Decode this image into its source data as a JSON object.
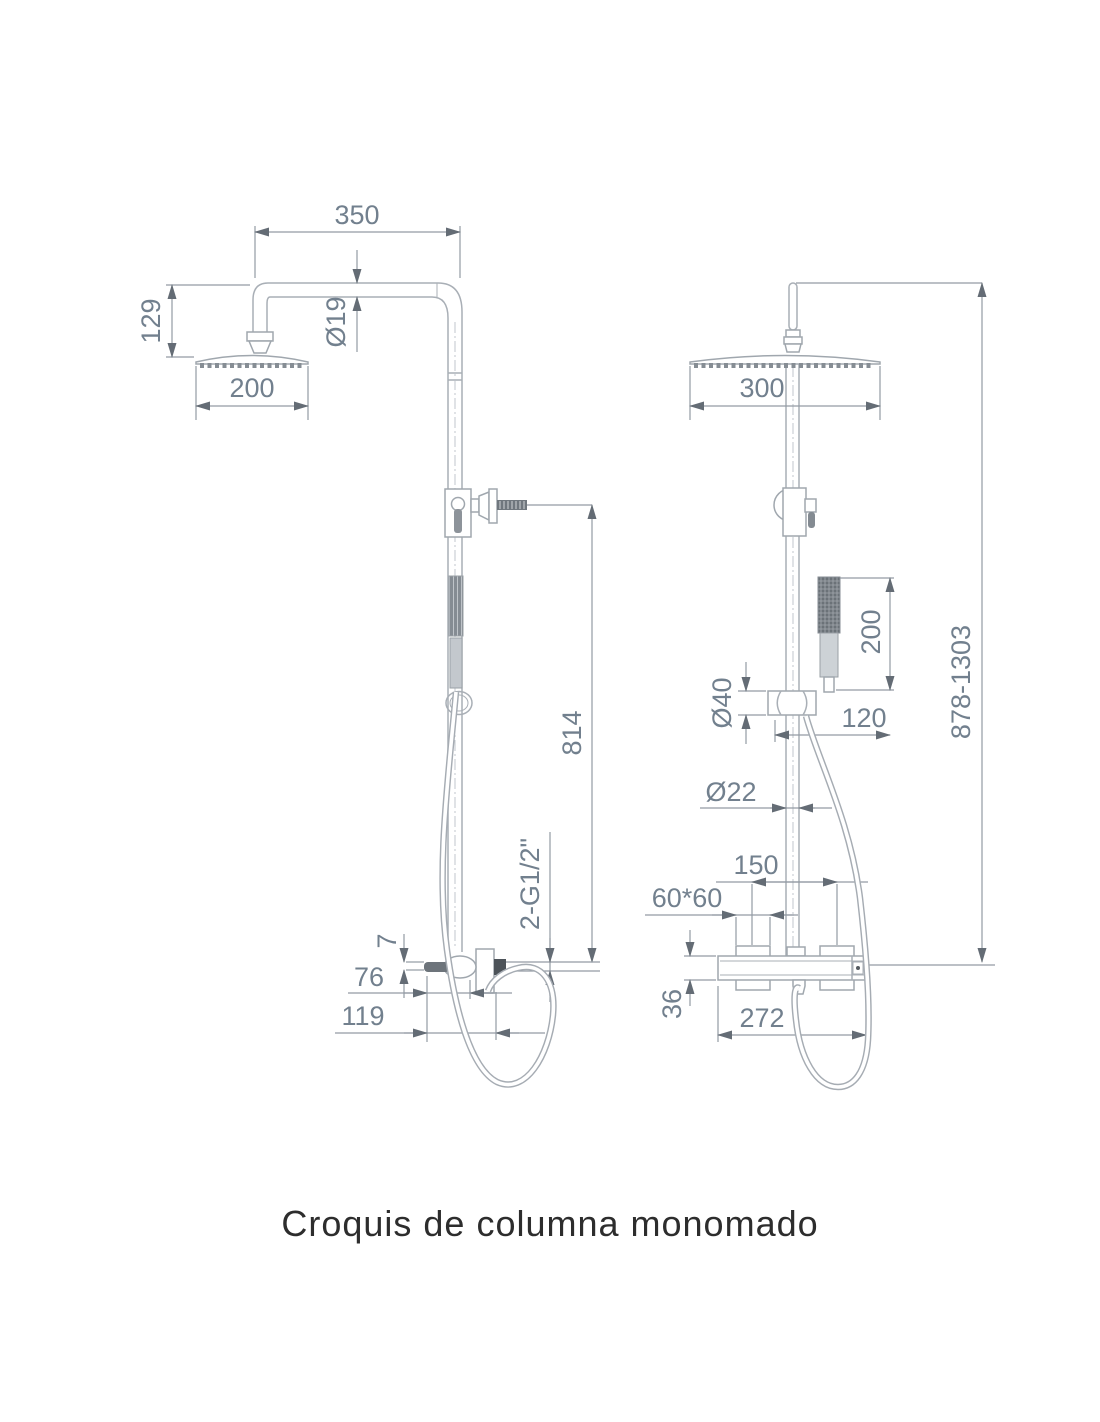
{
  "diagram": {
    "title": "Croquis de columna monomado",
    "left_view": {
      "name": "front-elevation",
      "dimensions": {
        "arm_projection": "350",
        "head_offset": "129",
        "head_width": "200",
        "arm_pipe_diameter": "Ø19",
        "slide_bar_height": "814",
        "plate_thickness": "7",
        "outlet_depth": "76",
        "handle_depth": "119",
        "inlet_thread": "2-G1/2\""
      }
    },
    "right_view": {
      "name": "side-elevation",
      "dimensions": {
        "head_width": "300",
        "handshower_length": "200",
        "holder_diameter": "Ø40",
        "handshower_offset": "120",
        "column_pipe_diameter": "Ø22",
        "inlet_spacing": "150",
        "escutcheon_size": "60*60",
        "mixer_body_height": "36",
        "mixer_body_width": "272",
        "total_height": "878-1303"
      }
    },
    "colors": {
      "line": "#a9afb6",
      "dimension_line": "#939ba4",
      "dimension_text": "#72808e",
      "arrowhead": "#646c75",
      "dark_detail": "#585f66",
      "title_text": "#2d2d2d"
    }
  }
}
